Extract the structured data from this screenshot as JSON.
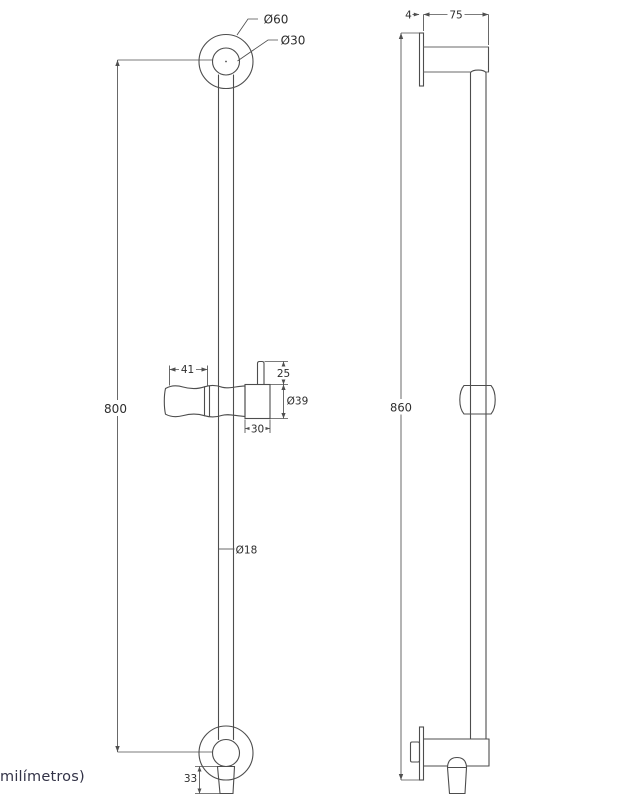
{
  "page": {
    "background": "#ffffff",
    "line_color": "#4d4d4d",
    "dim_line_color": "#4f4f4f",
    "dim_text_color": "#2d2d2d",
    "caption_color": "#333347"
  },
  "caption": {
    "text": "milímetros)"
  },
  "front_view": {
    "dims": {
      "top_outer_dia": "Ø60",
      "top_inner_dia": "Ø30",
      "bar_length": "800",
      "holder_width": "41",
      "knob_height": "25",
      "slider_dia": "Ø39",
      "block_width": "30",
      "bar_dia": "Ø18",
      "outlet_height": "33"
    }
  },
  "side_view": {
    "dims": {
      "plate_thickness": "4",
      "projection": "75",
      "overall_height": "860"
    }
  }
}
